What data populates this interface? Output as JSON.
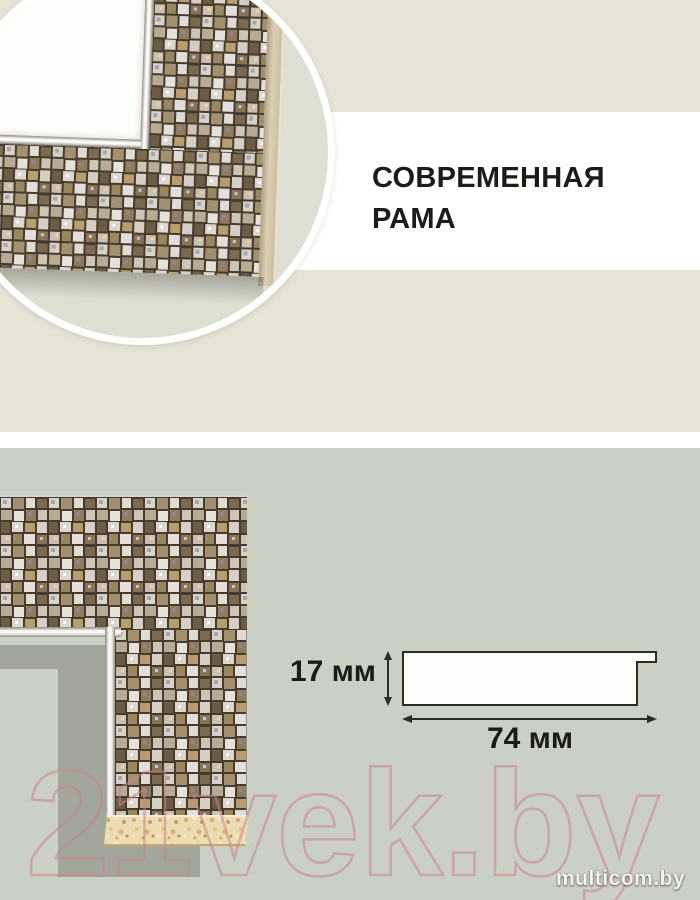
{
  "header": {
    "title_line1": "СОВРЕМЕННАЯ",
    "title_line2": "РАМА"
  },
  "diagram": {
    "height_label": "17 мм",
    "width_label": "74 мм"
  },
  "watermark": {
    "text": "21vek.by"
  },
  "brand": {
    "text": "multicom.by"
  },
  "colors": {
    "top-bg": "#e6e3d7",
    "band-bg": "#ffffff",
    "bottom-bg": "#cbd0c4",
    "circle-bg": "#dcdfd2",
    "ink": "#1b1b18",
    "outline": "#2b2b28",
    "shadow": "#a3a79b",
    "watermark-pink": "#c9838c",
    "chipboard": "#eddcb2",
    "grout": "#453b2e",
    "brand-text": "#f5f3ed"
  }
}
